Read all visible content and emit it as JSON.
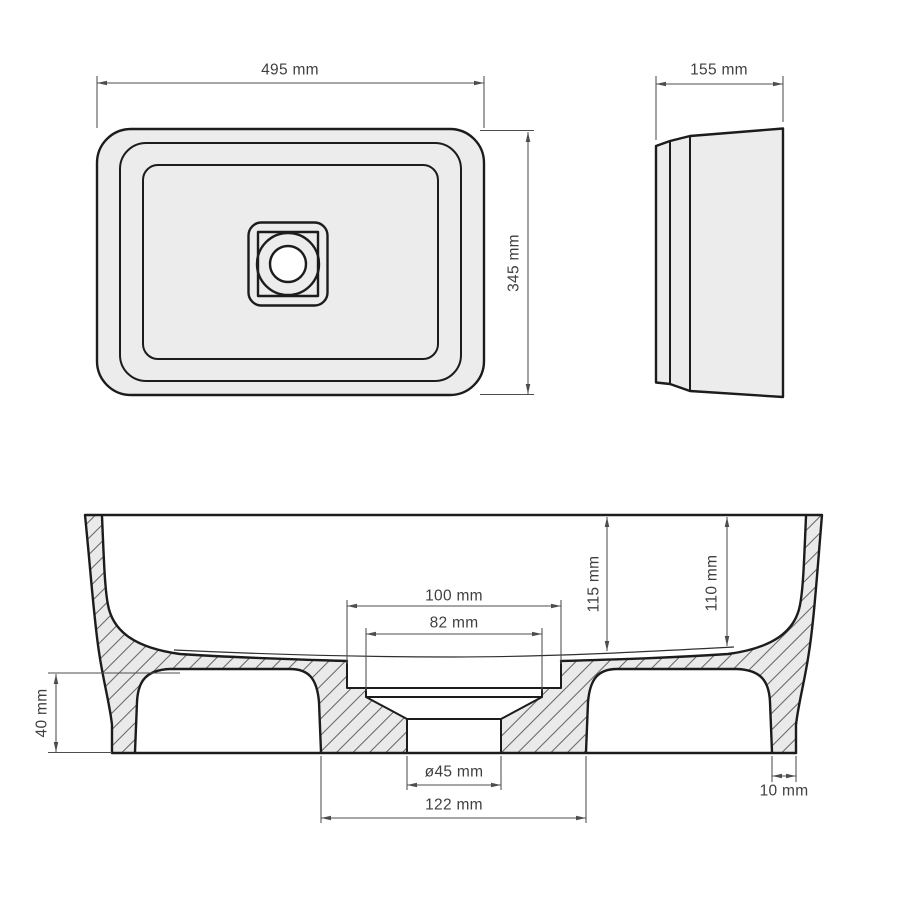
{
  "colors": {
    "background": "#ffffff",
    "fill": "#ececec",
    "outline": "#1c1c1c",
    "dim_line": "#4d4d4d",
    "text": "#3f3f3f",
    "hatch": "#6b6b6b",
    "white": "#ffffff"
  },
  "views": {
    "top_view": {
      "label_width": "495 mm",
      "label_depth": "345 mm"
    },
    "side_view": {
      "label_width": "155 mm"
    },
    "section_view": {
      "label_depth_inner": "115 mm",
      "label_depth_drain": "110 mm",
      "label_recess_outer": "100 mm",
      "label_recess_inner": "82 mm",
      "label_base_height": "40 mm",
      "label_drain_diameter": "ø45 mm",
      "label_base_width": "122 mm",
      "label_foot_thickness": "10 mm"
    }
  }
}
